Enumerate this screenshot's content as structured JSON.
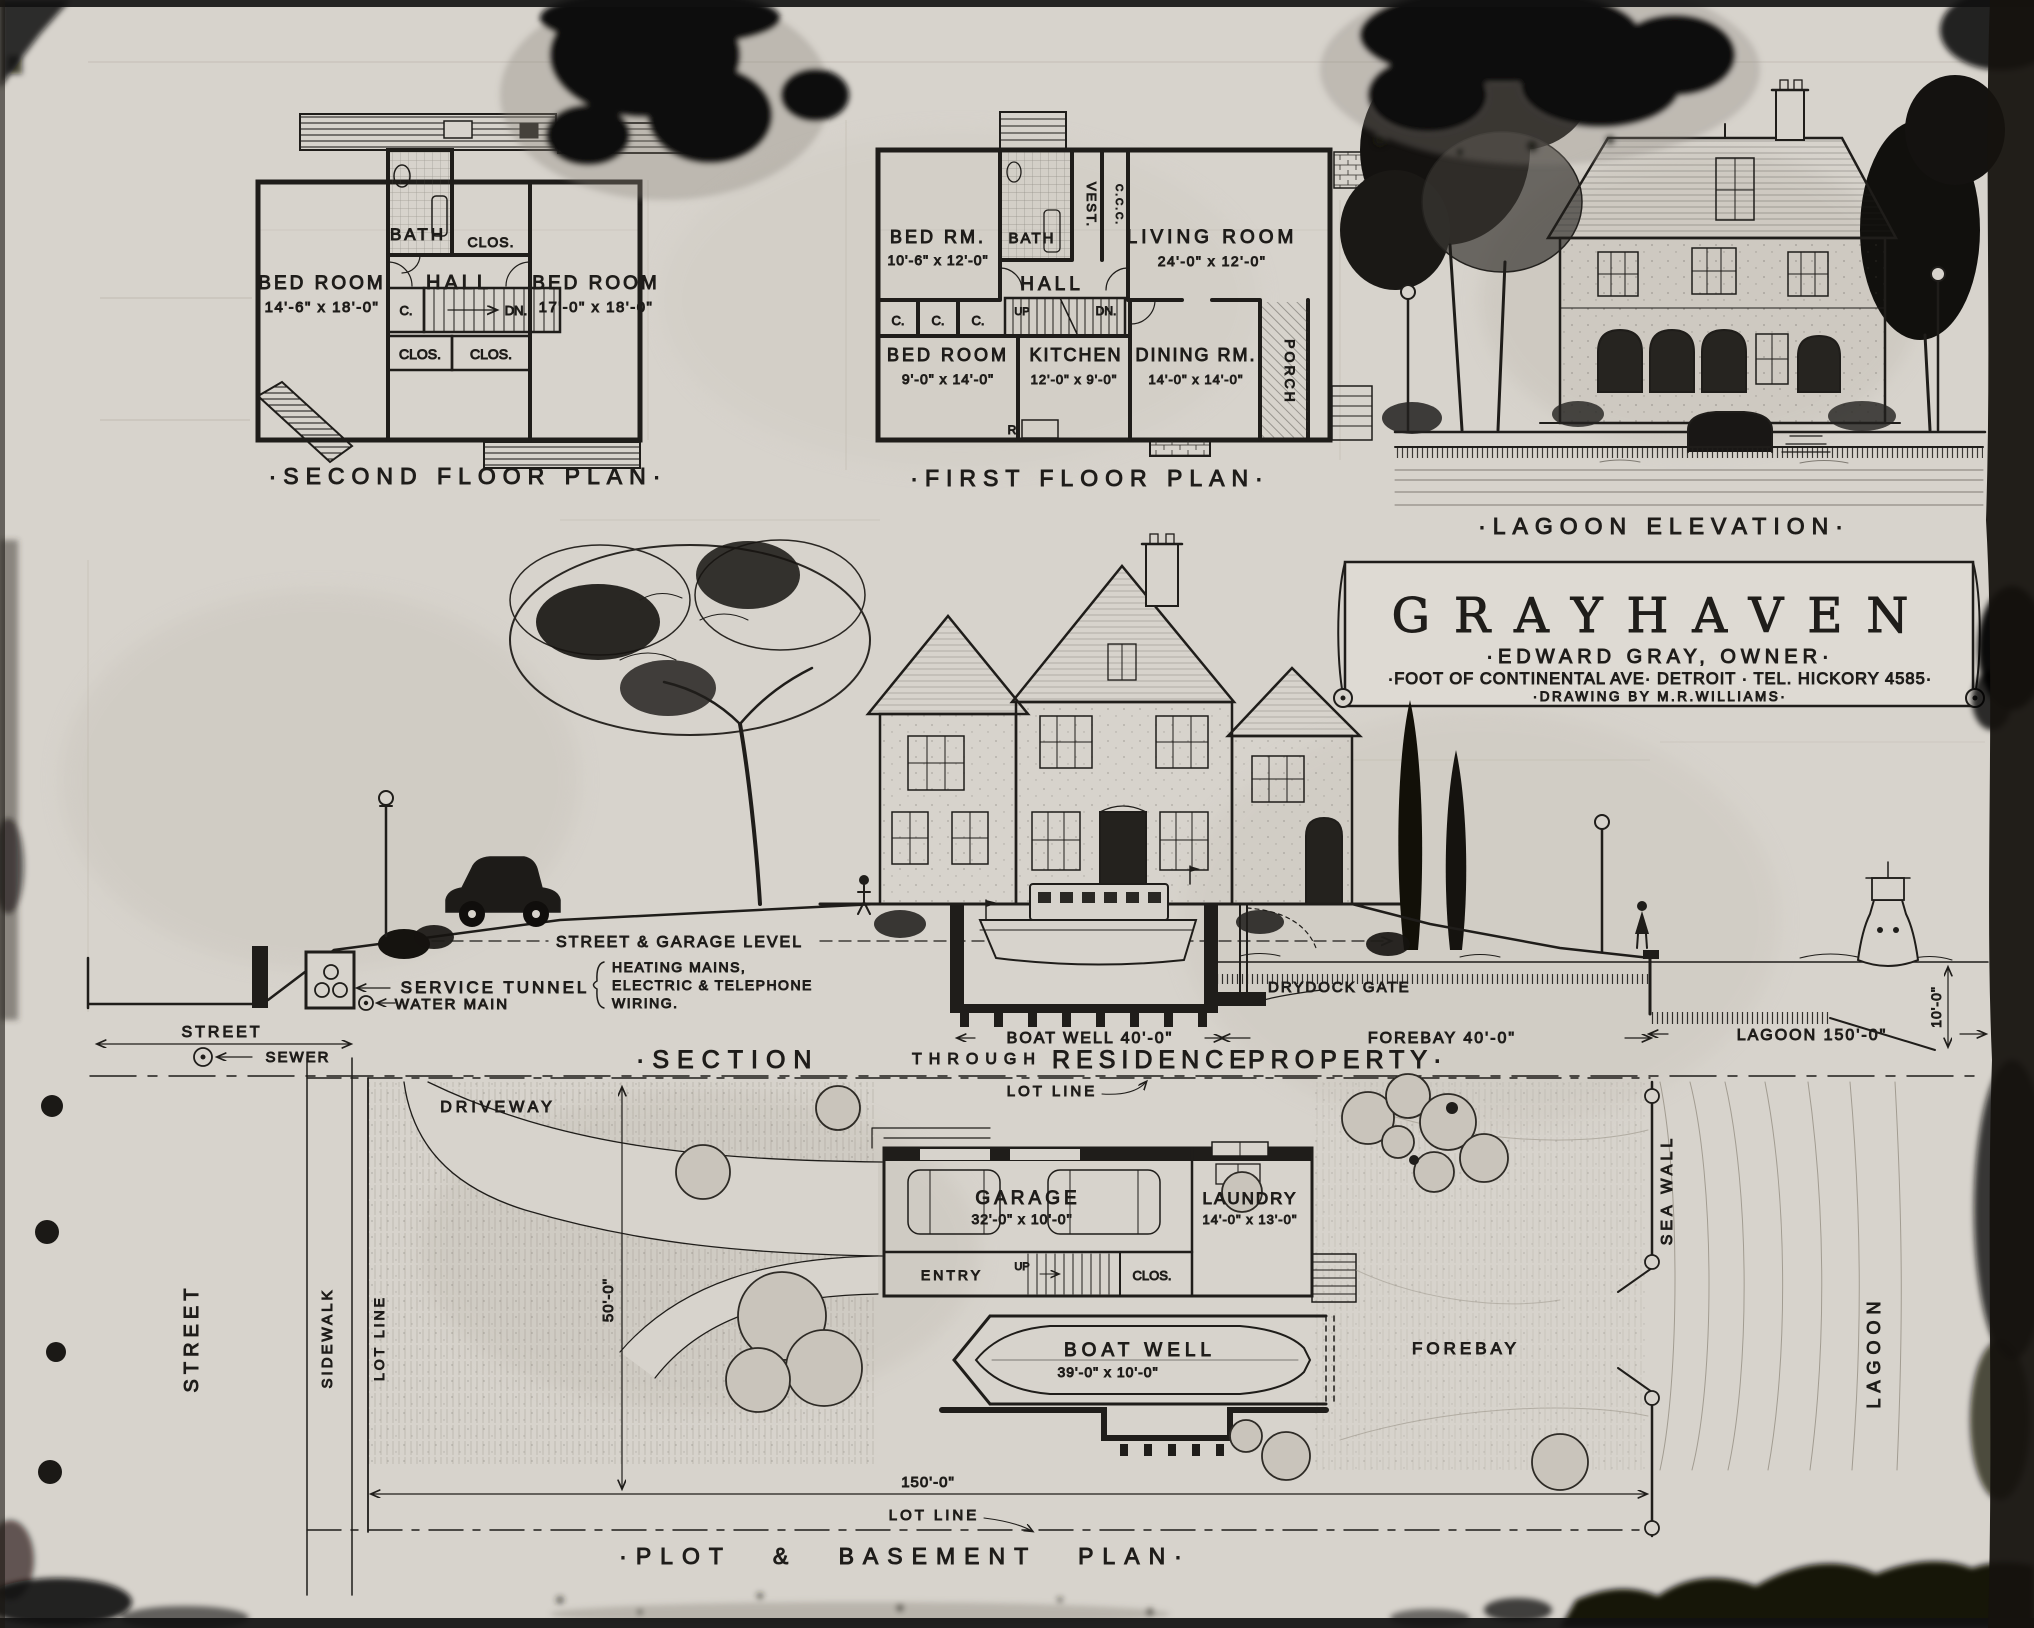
{
  "colors": {
    "paper": "#d7d3cc",
    "ink": "#1f1d1a",
    "pencil": "#9a9489",
    "stain": "#0b0a09"
  },
  "title_block": {
    "name": "GRAYHAVEN",
    "owner": "·EDWARD GRAY, OWNER·",
    "address": "·FOOT OF CONTINENTAL AVE· DETROIT · TEL. HICKORY 4585·",
    "credit": "·DRAWING BY M.R.WILLIAMS·"
  },
  "second_floor": {
    "title": "·SECOND FLOOR PLAN·",
    "bed_left": "BED ROOM",
    "bed_left_dims": "14'-6\" x 18'-0\"",
    "bed_right": "BED ROOM",
    "bed_right_dims": "17'-0\" x 18'-0\"",
    "hall": "HALL",
    "bath": "BATH",
    "clos_top": "CLOS.",
    "closet_c": "C.",
    "down": "DN.",
    "clos_b1": "CLOS.",
    "clos_b2": "CLOS."
  },
  "first_floor": {
    "title": "·FIRST FLOOR PLAN·",
    "bed_rm": "BED RM.",
    "bed_rm_dims": "10'-6\" x 12'-0\"",
    "bath": "BATH",
    "vest": "VEST.",
    "closets_vert": "C.C.C.",
    "living": "LIVING ROOM",
    "living_dims": "24'-0\" x 12'-0\"",
    "hall": "HALL",
    "c1": "C.",
    "c2": "C.",
    "c3": "C.",
    "up": "UP",
    "down": "DN.",
    "bed_room": "BED ROOM",
    "bed_room_dims": "9'-0\" x 14'-0\"",
    "kitchen": "KITCHEN",
    "kitchen_dims": "12'-0\" x 9'-0\"",
    "dining": "DINING RM.",
    "dining_dims": "14'-0\" x 14'-0\"",
    "porch": "PORCH",
    "range": "R"
  },
  "elevation": {
    "title": "·LAGOON ELEVATION·"
  },
  "section": {
    "title_1": "·SECTION",
    "title_2": "THROUGH",
    "title_3": "RESIDENCE",
    "title_4": "PROPERTY·",
    "street_garage_level": "STREET & GARAGE LEVEL",
    "service_tunnel": "SERVICE TUNNEL",
    "water_main": "WATER MAIN",
    "utilities_1": "HEATING MAINS,",
    "utilities_2": "ELECTRIC & TELEPHONE",
    "utilities_3": "WIRING.",
    "street": "STREET",
    "sewer": "SEWER",
    "boat_well_dim": "BOAT WELL 40'-0\"",
    "drydock_gate": "DRYDOCK GATE",
    "forebay_dim": "FOREBAY 40'-0\"",
    "lagoon_dim": "LAGOON 150'-0\"",
    "depth_dim": "10'-0\""
  },
  "plot": {
    "title": "·PLOT & BASEMENT PLAN·",
    "lot_line_top": "LOT LINE",
    "lot_line_bottom": "LOT LINE",
    "lot_line_left": "LOT LINE",
    "driveway": "DRIVEWAY",
    "street": "STREET",
    "sidewalk": "SIDEWALK",
    "width_dim": "50'-0\"",
    "length_dim": "150'-0\"",
    "garage": "GARAGE",
    "garage_dims": "32'-0\" x 10'-0\"",
    "laundry": "LAUNDRY",
    "laundry_dims": "14'-0\" x 13'-0\"",
    "entry": "ENTRY",
    "up": "UP",
    "clos": "CLOS.",
    "boat_well": "BOAT WELL",
    "boat_well_dims": "39'-0\" x 10'-0\"",
    "forebay": "FOREBAY",
    "sea_wall": "SEA WALL",
    "lagoon": "LAGOON"
  }
}
